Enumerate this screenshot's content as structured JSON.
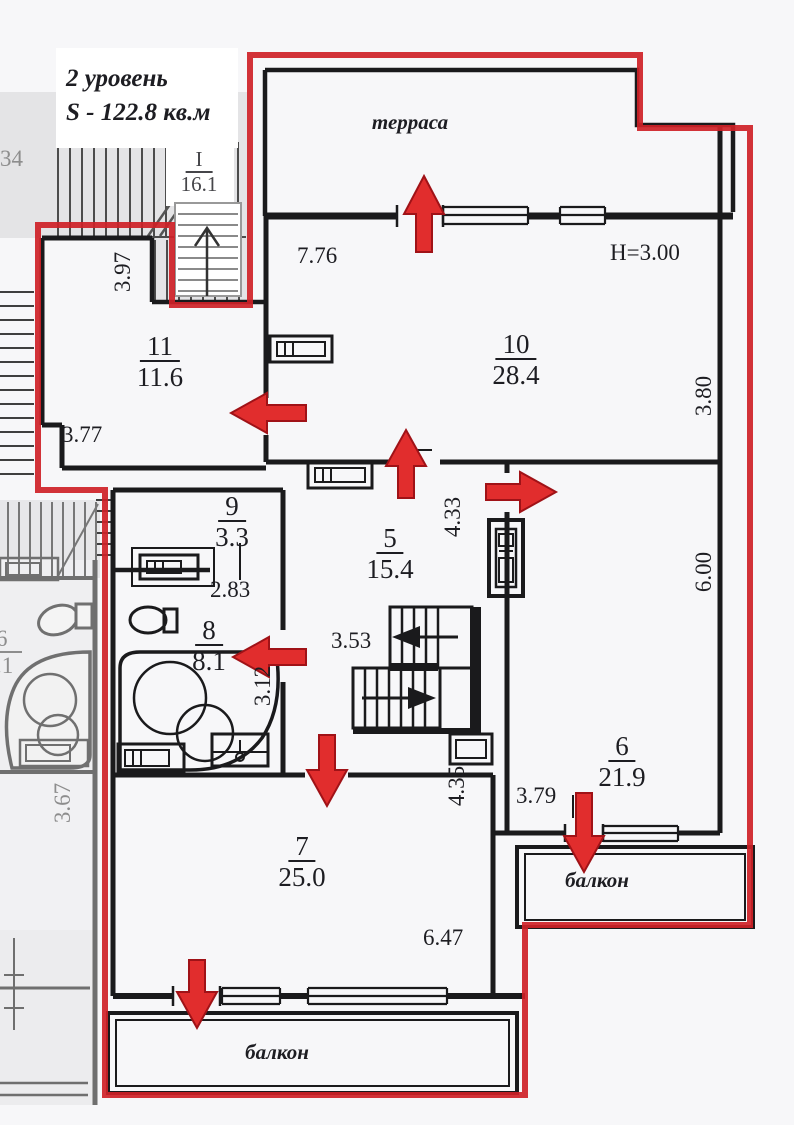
{
  "title": {
    "line1": "2 уровень",
    "line2": "S - 122.8 кв.м"
  },
  "areas": {
    "terrace": "терраса",
    "balcony_right": "балкон",
    "balcony_bottom": "балкон"
  },
  "ceiling_height": "H=3.00",
  "stairwell": {
    "number": "I",
    "area": "16.1"
  },
  "rooms": {
    "r5": {
      "number": "5",
      "area": "15.4"
    },
    "r6": {
      "number": "6",
      "area": "21.9"
    },
    "r7": {
      "number": "7",
      "area": "25.0"
    },
    "r8": {
      "number": "8",
      "area": "8.1"
    },
    "r9": {
      "number": "9",
      "area": "3.3"
    },
    "r10": {
      "number": "10",
      "area": "28.4"
    },
    "r11": {
      "number": "11",
      "area": "11.6"
    }
  },
  "dims": {
    "room10_width": "7.76",
    "room10_depth": "3.80",
    "room6_depth": "6.00",
    "room11_depth": "3.97",
    "room11_width": "3.77",
    "room8_width": "2.83",
    "hall_depth": "4.33",
    "hall_width": "3.53",
    "room8_depth": "3.12",
    "room7_depth": "4.35",
    "balcony_right_width": "3.79",
    "room7_width": "6.47",
    "neighbor_depth": "3.67"
  },
  "neighbor": {
    "cut_number": "34",
    "room_number": "6",
    "room_area": ".1"
  },
  "colors": {
    "outline_red": "#ce2127",
    "walls": "#1a1a1c",
    "neighbor_gray": "#8f8f8f",
    "arrow": "#e12d2d"
  }
}
